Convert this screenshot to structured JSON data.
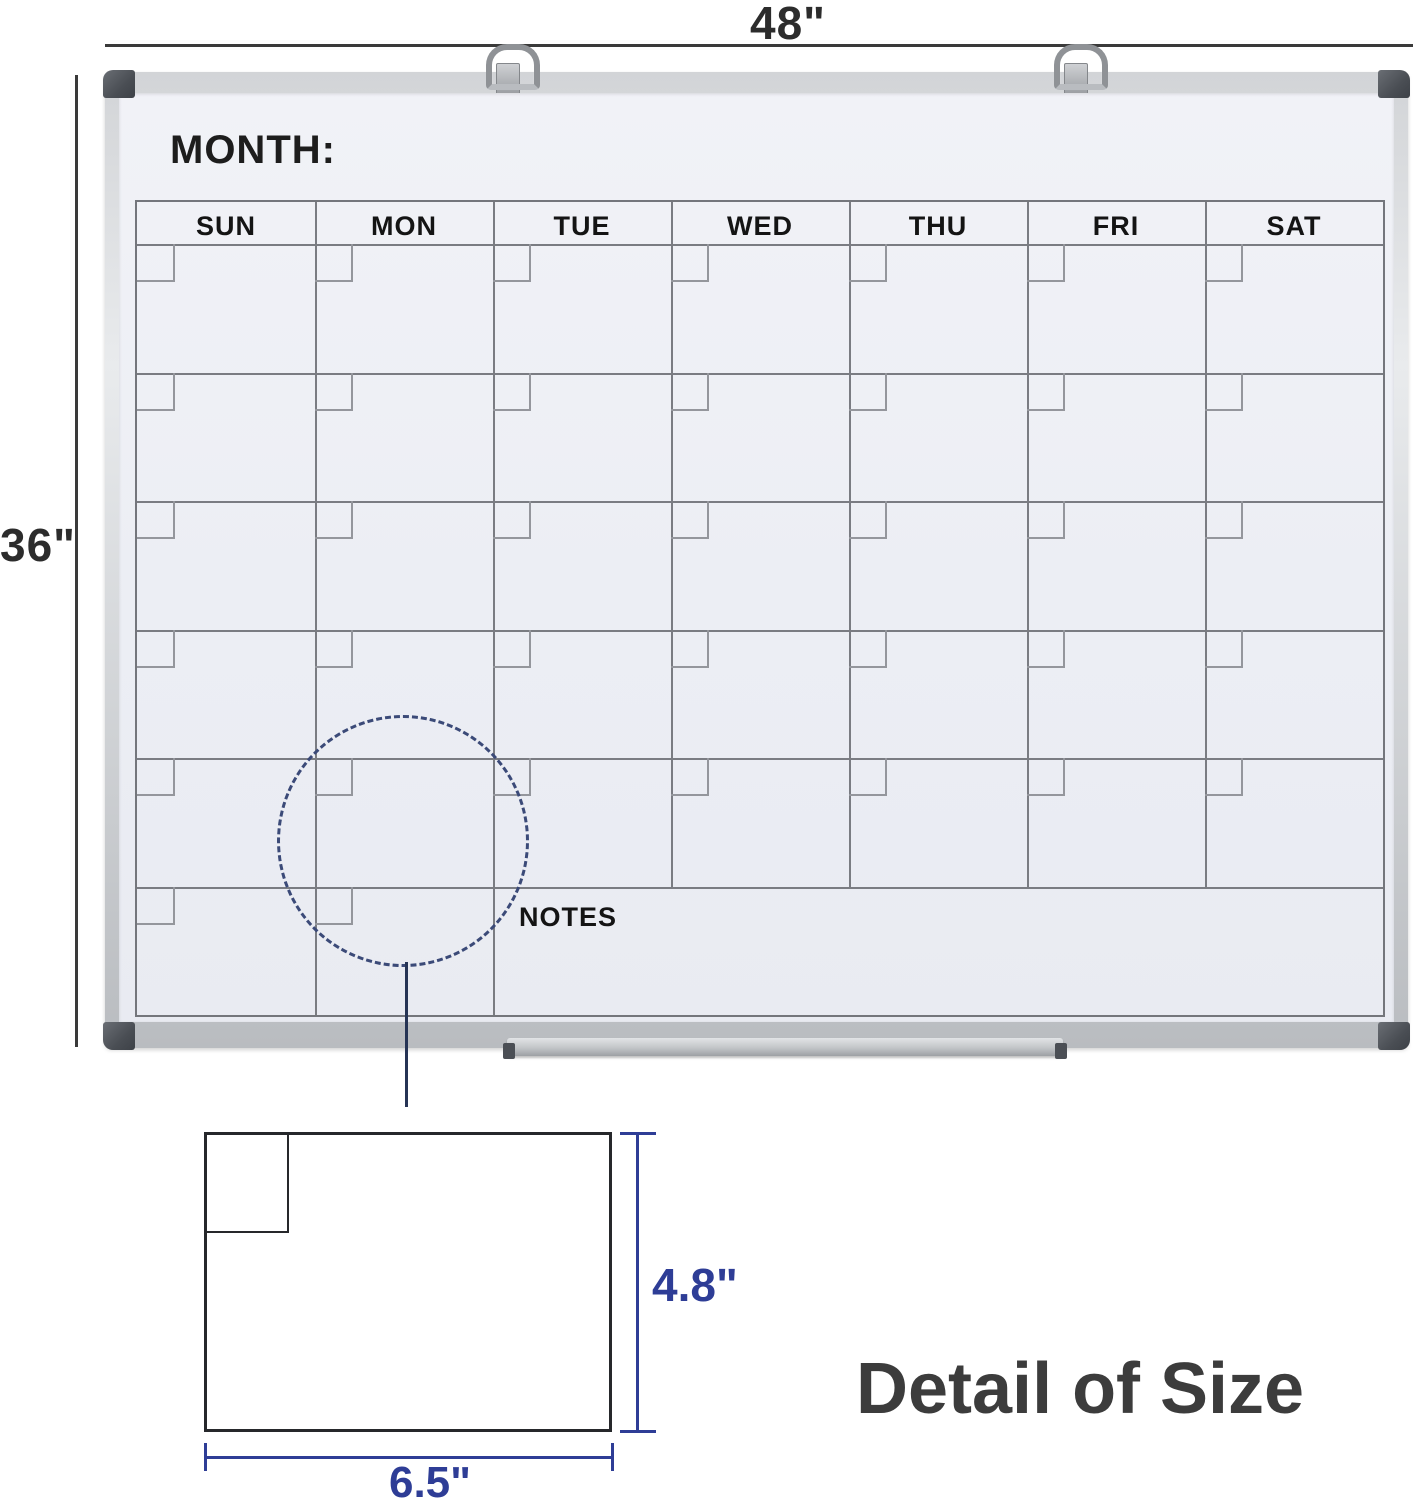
{
  "annotations": {
    "board_width_label": "48\"",
    "board_height_label": "36\"",
    "cell_height_label": "4.8\"",
    "cell_width_label": "6.5\"",
    "detail_title": "Detail of Size"
  },
  "board": {
    "month_label": "MONTH:",
    "notes_label": "NOTES",
    "day_headers": [
      "SUN",
      "MON",
      "TUE",
      "WED",
      "THU",
      "FRI",
      "SAT"
    ]
  },
  "icons": {
    "hanging_ring_left": "d-ring-hanger",
    "hanging_ring_right": "d-ring-hanger"
  },
  "colors": {
    "dimension_accent_blue": "#2e3d96",
    "dimension_line_dark": "#3a3a3a",
    "highlight_circle_navy": "#3b4a78",
    "board_surface": "#edeff5",
    "grid_line_gray": "#74767c",
    "frame_silver": "#c9cbce",
    "corner_cap_gray": "#4a4e54"
  }
}
